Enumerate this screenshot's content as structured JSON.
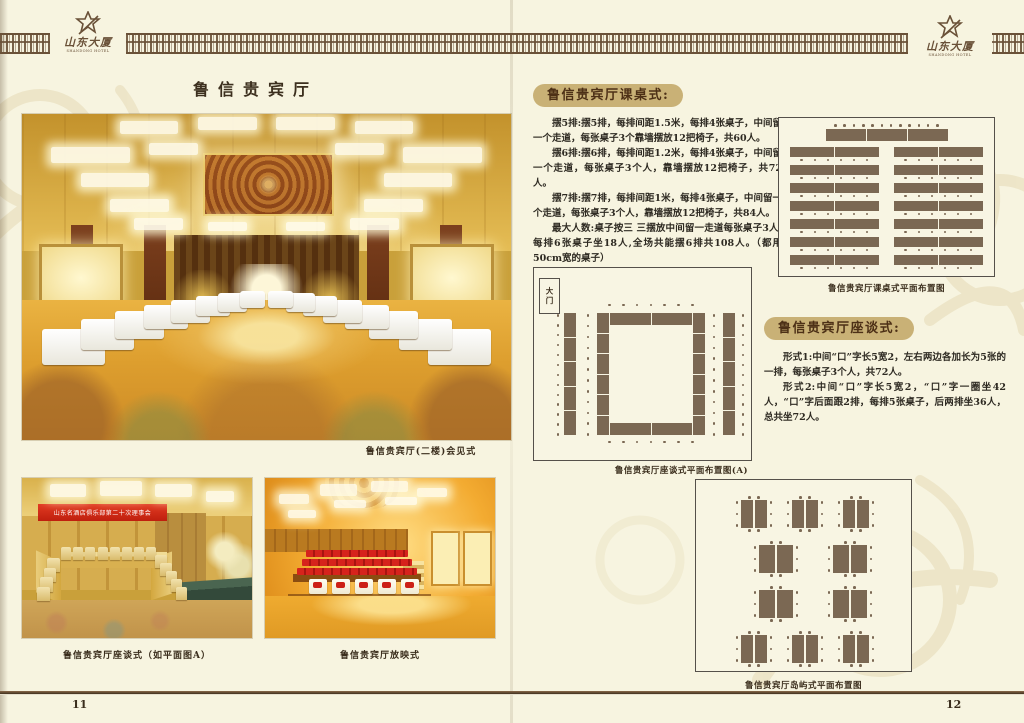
{
  "logo": {
    "name": "山东大厦",
    "subtitle": "SHANDONG HOTEL"
  },
  "left_page": {
    "page_number": "11",
    "title": "鲁信贵宾厅",
    "main_photo_caption": "鲁信贵宾厅(二楼)会见式",
    "photo_a": {
      "caption": "鲁信贵宾厅座谈式（如平面图A）",
      "banner_text": "山东名酒店俱乐部第二十次理事会"
    },
    "photo_b": {
      "caption": "鲁信贵宾厅放映式"
    }
  },
  "right_page": {
    "page_number": "12",
    "classroom_section": {
      "heading": "鲁信贵宾厅课桌式:",
      "paragraphs": [
        "摆5排:摆5排，每排间距1.5米，每排4张桌子，中间留一个走道，每张桌子3个靠墙摆放12把椅子，共60人。",
        "摆6排:摆6排，每排间距1.2米，每排4张桌子，中间留一个走道，每张桌子3个人，靠墙摆放12把椅子，共72人。",
        "摆7排:摆7排，每排间距1米，每排4张桌子，中间留一个走道，每张桌子3个人，靠墙摆放12把椅子，共84人。",
        "最大人数:桌子按三 三摆放中间留一走道每张桌子3人,每排6张桌子坐18人,全场共能摆6排共108人。（都用50cm宽的桌子）"
      ],
      "diagram_caption": "鲁信贵宾厅课桌式平面布置图"
    },
    "boardroom_section": {
      "heading": "鲁信贵宾厅座谈式:",
      "paragraphs": [
        "形式1:中间“口”字长5宽2，左右两边各加长为5张的一排，每张桌子3个人，共72人。",
        "形式2:中间“口”字长5宽2，“口”字一圈坐42人，“口”字后面跟2排，每排5张桌子，后两排坐36人，总共坐72人。"
      ],
      "diagram_caption": "鲁信贵宾厅座谈式平面布置图(A)",
      "door_label": "大门"
    },
    "island_section": {
      "diagram_caption": "鲁信贵宾厅岛屿式平面布置图"
    }
  },
  "diagrams": {
    "classroom": {
      "head_segments": 3,
      "head_chairs": 12,
      "columns": 2,
      "rows": 7,
      "segments_per_row": 2,
      "chairs_per_row": 6
    },
    "boardroom": {
      "ring_top_segments": 2,
      "ring_side_segments": 6,
      "outer_segments": 5,
      "outer_chairs": 13,
      "ring_side_chairs": 12,
      "ring_top_chairs": 7
    },
    "island": {
      "clusters_per_row": [
        3,
        2,
        2,
        3
      ],
      "tables_per_cluster": 2,
      "chairs_top": 2,
      "chairs_bottom": 2,
      "chairs_left": 3,
      "chairs_right": 3
    }
  },
  "colors": {
    "table": "#7b6853",
    "badge_bg": "#c9b176",
    "band": "#6a5138",
    "text": "#2e2a22",
    "page_bg": "#f7f4e0",
    "accent_red": "#cf2b1d"
  }
}
